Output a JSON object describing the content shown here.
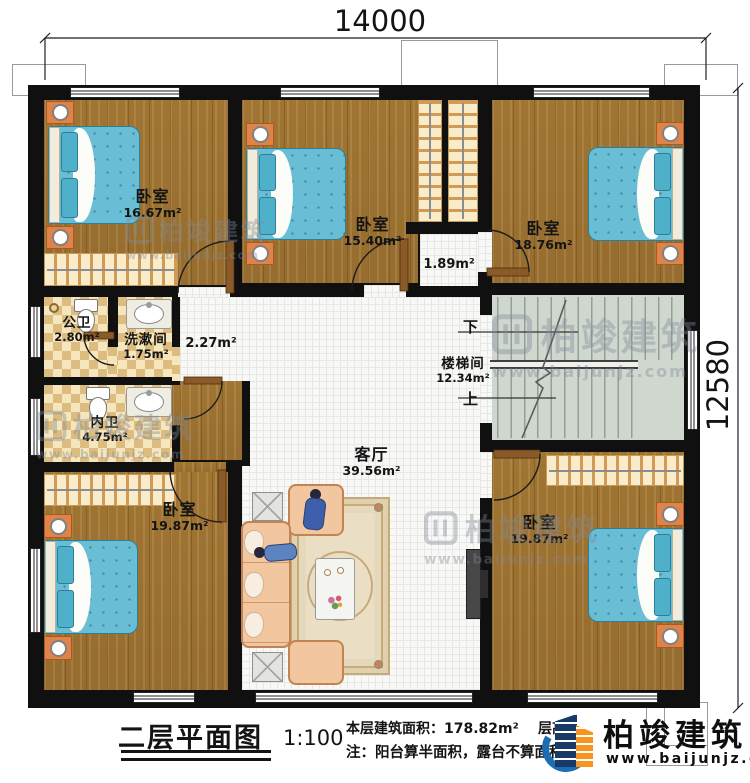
{
  "dimensions": {
    "top": "14000",
    "right": "12580"
  },
  "rooms": {
    "bedroom_tl": {
      "name": "卧室",
      "area": "16.67m²"
    },
    "bedroom_m": {
      "name": "卧室",
      "area": "15.40m²"
    },
    "bedroom_tr": {
      "name": "卧室",
      "area": "18.76m²"
    },
    "bedroom_bl": {
      "name": "卧室",
      "area": "19.87m²"
    },
    "bedroom_br": {
      "name": "卧室",
      "area": "19.87m²"
    },
    "living": {
      "name": "客厅",
      "area": "39.56m²"
    },
    "stairwell": {
      "name": "楼梯间",
      "area": "12.34m²"
    },
    "bath_public": {
      "name": "公卫",
      "area": "2.80m²"
    },
    "washroom": {
      "name": "洗漱间",
      "area": "1.75m²"
    },
    "bath_private": {
      "name": "内卫",
      "area": "4.75m²"
    }
  },
  "annotations": {
    "corridor_area": "2.27m²",
    "closet_area": "1.89m²"
  },
  "stairs": {
    "down": "下",
    "up": "上"
  },
  "title_block": {
    "title": "二层平面图",
    "scale": "1:100",
    "area_line": "本层建筑面积：178.82m²",
    "height_label": "层高：",
    "note_line": "注：阳台算半面积，露台不算面积"
  },
  "brand": {
    "name": "柏竣建筑",
    "website": "www.baijunjz.com"
  },
  "watermark": {
    "name": "柏竣建筑",
    "website": "www.baijunjz.com"
  },
  "colors": {
    "wall": "#101010",
    "wood_floor": "#a87c38",
    "bed_teal": "#69bed5",
    "nightstand_orange": "#e08348",
    "brand_blue": "#173a66",
    "brand_orange": "#f7941d",
    "swoosh_blue": "#1d6db3"
  }
}
